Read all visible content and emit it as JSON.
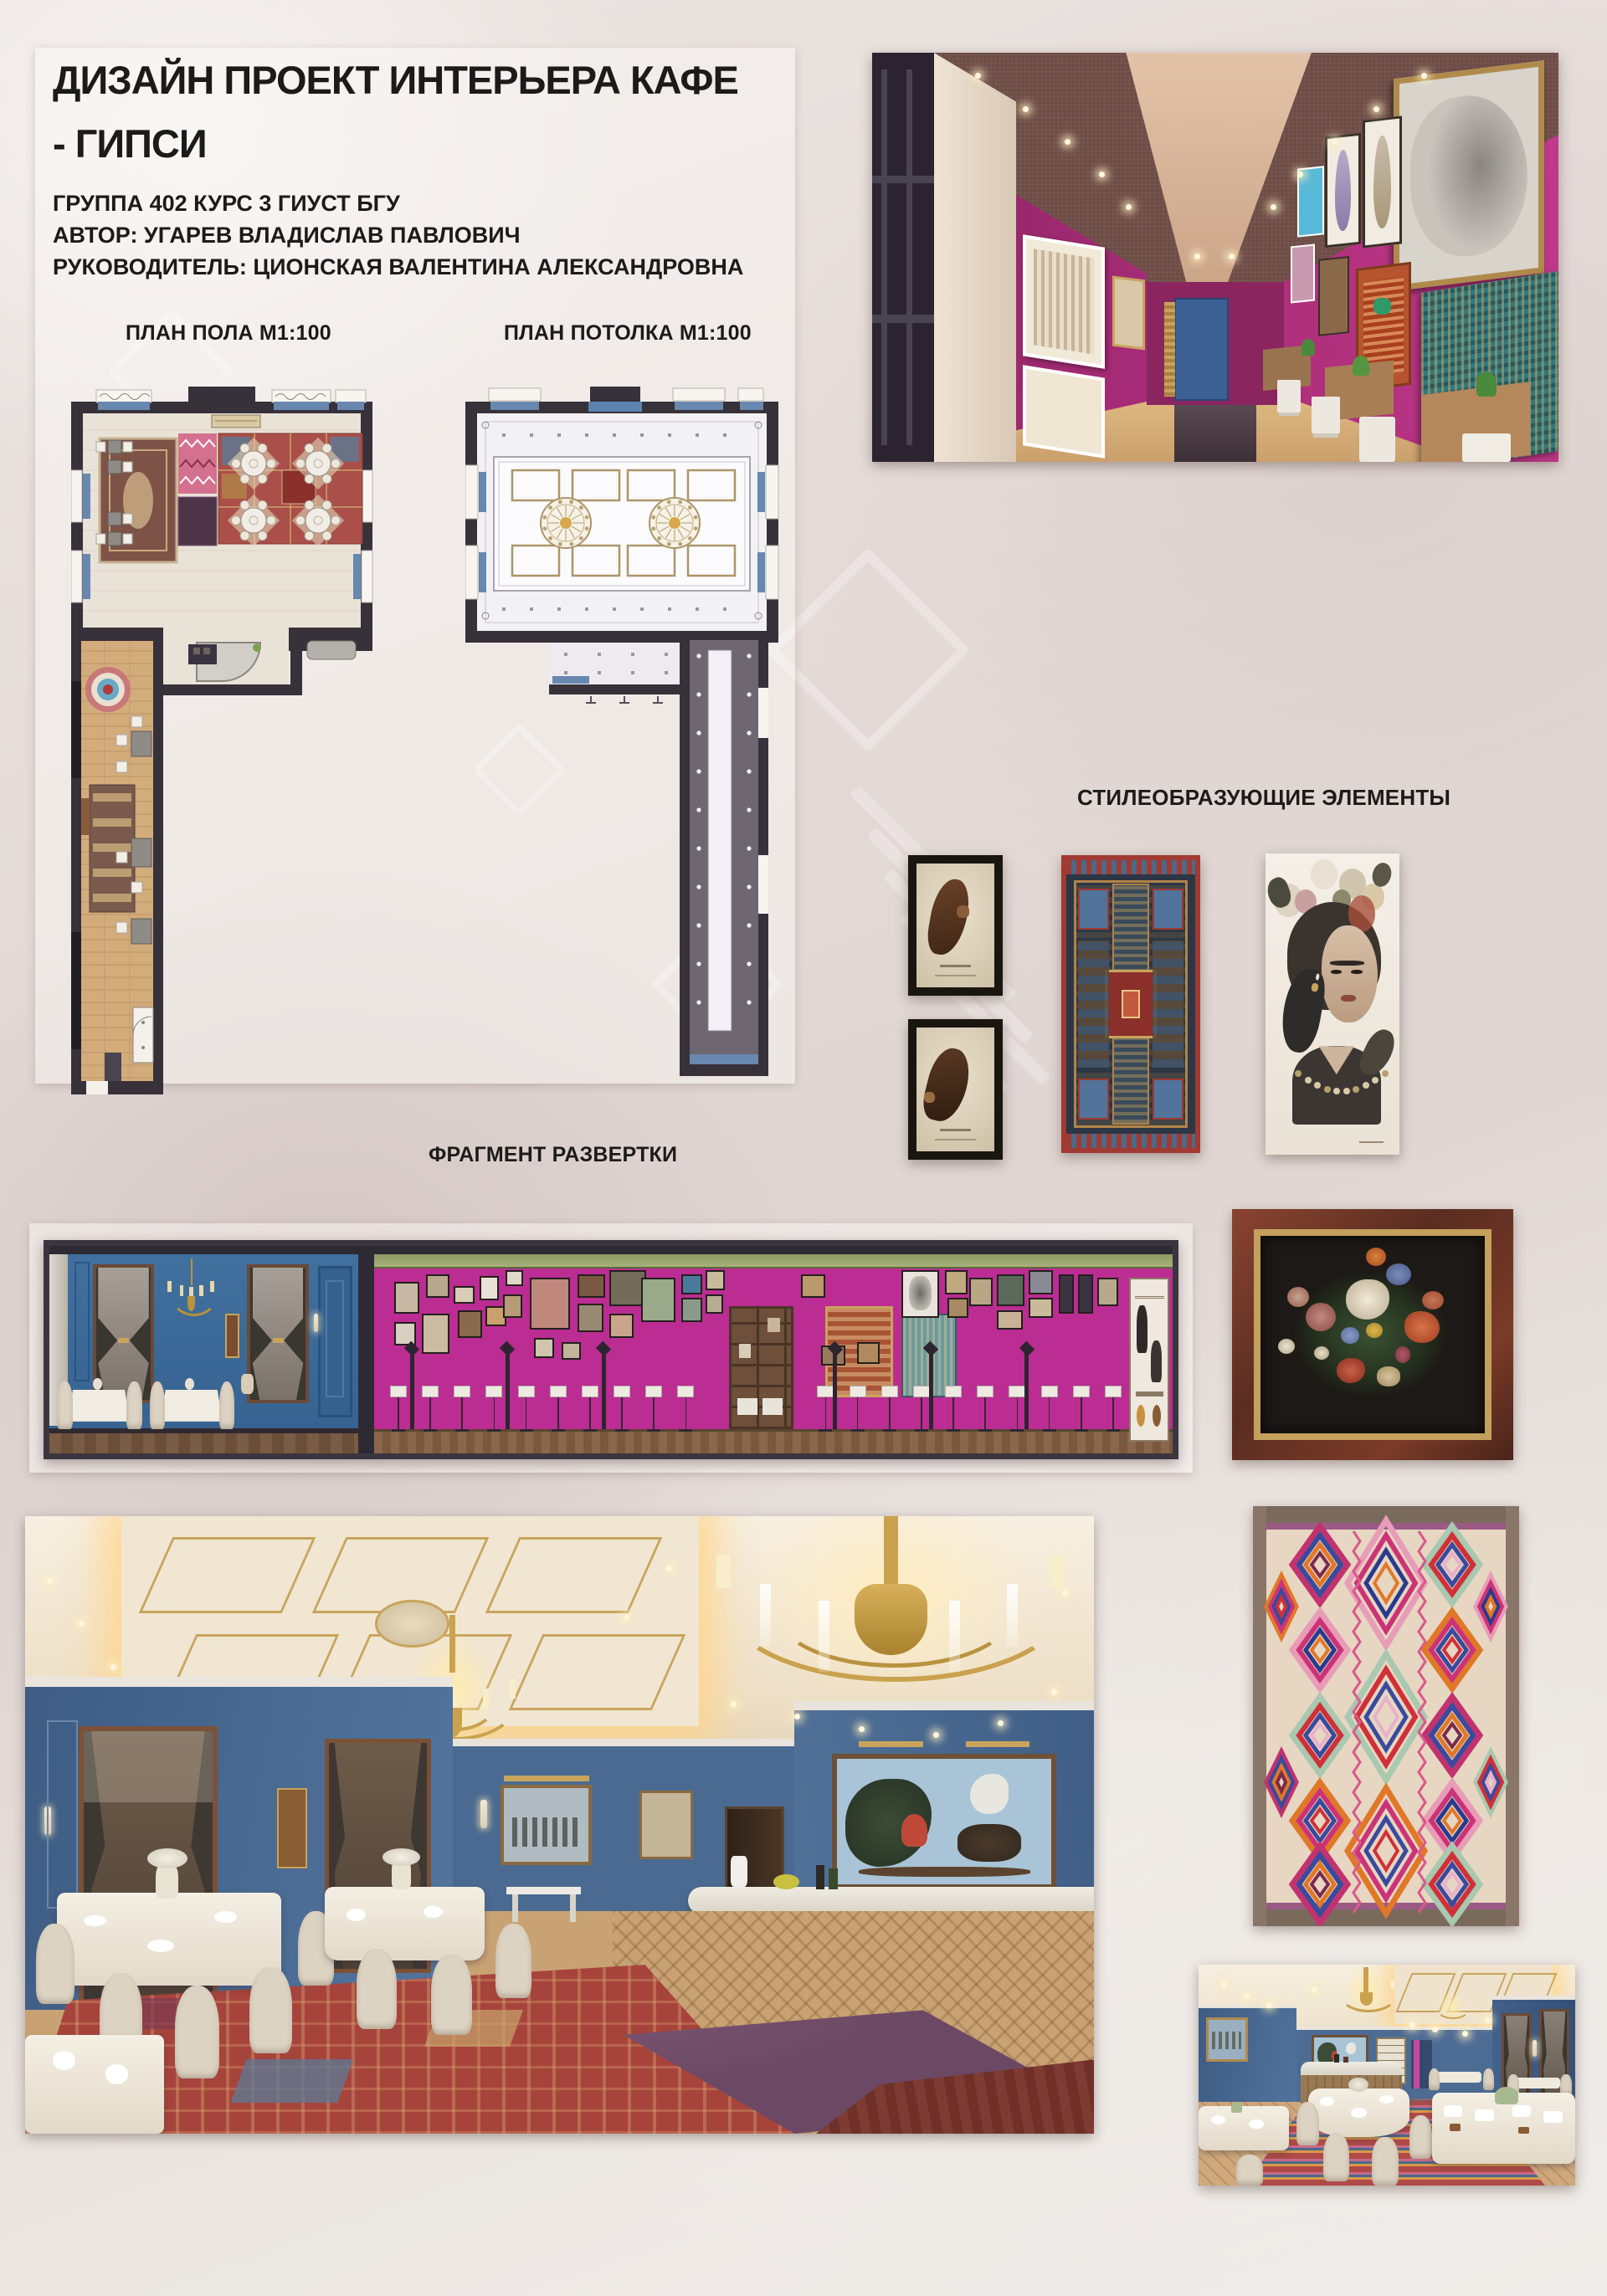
{
  "title": {
    "line1": "ДИЗАЙН ПРОЕКТ ИНТЕРЬЕРА КАФЕ",
    "line2": "-  ГИПСИ",
    "group": "ГРУППА 402 КУРС 3 ГИУСТ БГУ",
    "author": "АВТОР: УГАРЕВ ВЛАДИСЛАВ ПАВЛОВИЧ",
    "supervisor": "РУКОВОДИТЕЛЬ: ЦИОНСКАЯ ВАЛЕНТИНА АЛЕКСАНДРОВНА"
  },
  "labels": {
    "floor_plan": "ПЛАН ПОЛА М1:100",
    "ceiling_plan": "ПЛАН ПОТОЛКА М1:100",
    "style_elements": "СТИЛЕОБРАЗУЮЩИЕ ЭЛЕМЕНТЫ",
    "elevation": "ФРАГМЕНТ РАЗВЕРТКИ"
  },
  "palette": {
    "background": "#e6dedb",
    "ink": "#1c1b1a",
    "magenta_wall": "#b02e7e",
    "magenta_elevation": "#bb2d92",
    "plan_wall": "#37313a",
    "plan_floor": "#e9e2d7",
    "corridor_wood": "#d3ac7c",
    "ceiling_white": "#f2f1f4",
    "gold": "#c2a05c",
    "blue_wall": "#4c6d95",
    "blue_plan": "#6888b0",
    "carpet_red": "#a6443c",
    "elevation_blue": "#3f6ca2",
    "ceiling_brown": "#6f4e48"
  }
}
